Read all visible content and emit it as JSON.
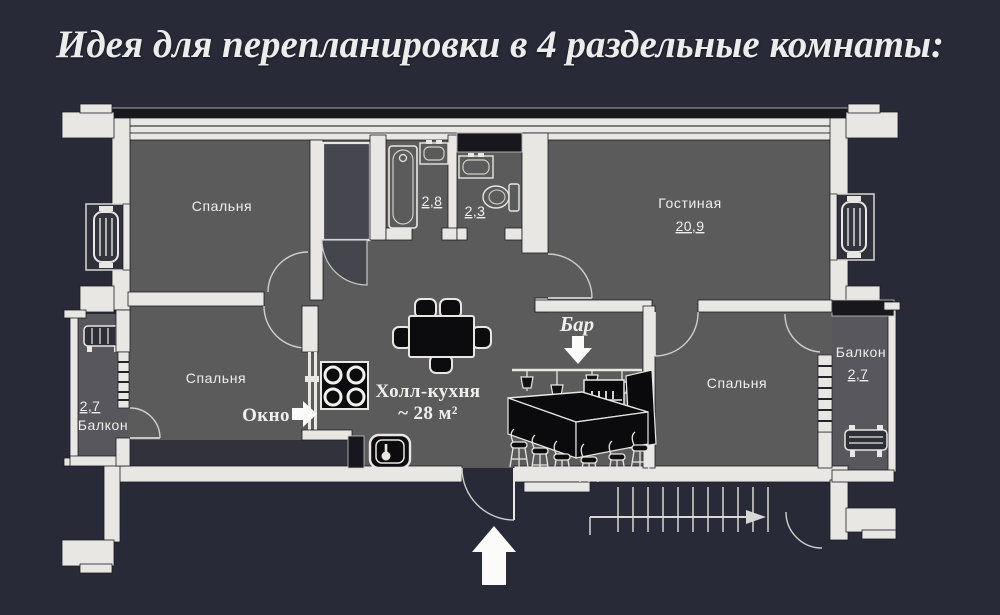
{
  "title": "Идея для перепланировки в 4 раздельные комнаты:",
  "colors": {
    "background": "#282a37",
    "wall": "#e8e7e3",
    "room_fill": "#5b5b5b",
    "furniture_black": "#0c0c0f",
    "text": "#eeeeec"
  },
  "rooms": {
    "bedroom_top_left": {
      "label": "Спальня"
    },
    "living_room": {
      "label": "Гостиная",
      "area": "20,9"
    },
    "bathroom": {
      "area": "2,8"
    },
    "wc": {
      "area": "2,3"
    },
    "bedroom_bottom_left": {
      "label": "Спальня"
    },
    "bedroom_bottom_right": {
      "label": "Спальня"
    },
    "hall_kitchen": {
      "label": "Холл-кухня",
      "area": "~ 28 м²"
    },
    "balcony_left": {
      "label": "Балкон",
      "area": "2,7"
    },
    "balcony_right": {
      "label": "Балкон",
      "area": "2,7"
    }
  },
  "annotations": {
    "window": "Окно",
    "bar": "Бар"
  }
}
